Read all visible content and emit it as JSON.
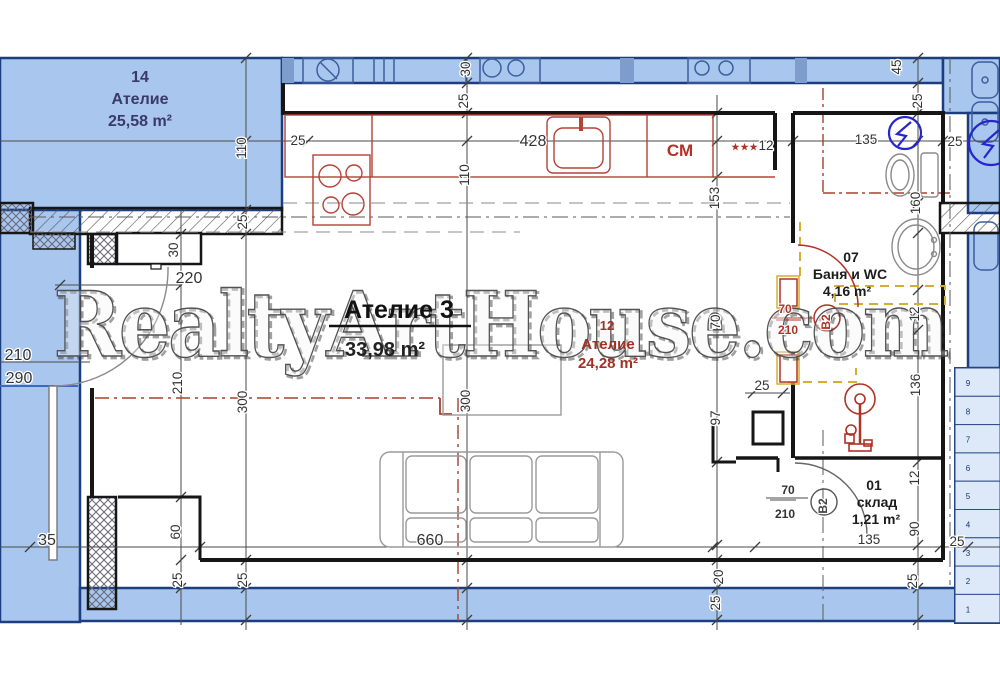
{
  "watermark": "RealtyArtHouse.com",
  "rooms": {
    "unit14": {
      "number": "14",
      "name": "Ателие",
      "area": "25,58 m²"
    },
    "main": {
      "title": "Ателие 3",
      "area": "33,98 m²"
    },
    "unit12": {
      "number": "12",
      "name": "Ателие",
      "area": "24,28 m²"
    },
    "bathroom": {
      "number": "07",
      "name": "Баня и WC",
      "area": "4,16 m²"
    },
    "storage": {
      "number": "01",
      "name": "склад",
      "area": "1,21 m²"
    }
  },
  "labels": {
    "washing_machine": "СМ",
    "stars": "★★★"
  },
  "doors": {
    "bathroom": {
      "width": "70",
      "height": "210",
      "code": "B2"
    },
    "storage": {
      "width": "70",
      "height": "210",
      "code": "B2"
    },
    "entrance": {
      "width": "210",
      "height": "290"
    }
  },
  "dimensions": [
    {
      "t": "110",
      "x": 246,
      "y": 148,
      "r": 1
    },
    {
      "t": "25",
      "x": 298,
      "y": 145,
      "r": 0
    },
    {
      "t": "30",
      "x": 470,
      "y": 69,
      "r": 1
    },
    {
      "t": "25",
      "x": 468,
      "y": 101,
      "r": 1
    },
    {
      "t": "428",
      "x": 533,
      "y": 146,
      "r": 0,
      "big": 1
    },
    {
      "t": "110",
      "x": 469,
      "y": 175,
      "r": 1
    },
    {
      "t": "12",
      "x": 766,
      "y": 150,
      "r": 0
    },
    {
      "t": "153",
      "x": 719,
      "y": 198,
      "r": 1
    },
    {
      "t": "135",
      "x": 866,
      "y": 144,
      "r": 0
    },
    {
      "t": "45",
      "x": 901,
      "y": 67,
      "r": 1
    },
    {
      "t": "25",
      "x": 922,
      "y": 101,
      "r": 1
    },
    {
      "t": "25",
      "x": 955,
      "y": 146,
      "r": 0
    },
    {
      "t": "160",
      "x": 920,
      "y": 203,
      "r": 1
    },
    {
      "t": "25",
      "x": 247,
      "y": 222,
      "r": 1
    },
    {
      "t": "30",
      "x": 178,
      "y": 250,
      "r": 1
    },
    {
      "t": "220",
      "x": 189,
      "y": 283,
      "r": 0,
      "big": 1
    },
    {
      "t": "210",
      "x": 182,
      "y": 383,
      "r": 1
    },
    {
      "t": "300",
      "x": 247,
      "y": 402,
      "r": 1
    },
    {
      "t": "300",
      "x": 470,
      "y": 401,
      "r": 1
    },
    {
      "t": "70",
      "x": 720,
      "y": 322,
      "r": 1
    },
    {
      "t": "97",
      "x": 720,
      "y": 418,
      "r": 1
    },
    {
      "t": "12",
      "x": 919,
      "y": 314,
      "r": 1
    },
    {
      "t": "136",
      "x": 920,
      "y": 385,
      "r": 1
    },
    {
      "t": "25",
      "x": 762,
      "y": 390,
      "r": 0
    },
    {
      "t": "60",
      "x": 180,
      "y": 532,
      "r": 1
    },
    {
      "t": "35",
      "x": 47,
      "y": 545,
      "r": 0,
      "big": 1
    },
    {
      "t": "660",
      "x": 430,
      "y": 545,
      "r": 0,
      "big": 1
    },
    {
      "t": "135",
      "x": 869,
      "y": 544,
      "r": 0
    },
    {
      "t": "25",
      "x": 957,
      "y": 546,
      "r": 0
    },
    {
      "t": "12",
      "x": 919,
      "y": 478,
      "r": 1
    },
    {
      "t": "90",
      "x": 919,
      "y": 529,
      "r": 1
    },
    {
      "t": "20",
      "x": 723,
      "y": 577,
      "r": 1
    },
    {
      "t": "25",
      "x": 720,
      "y": 603,
      "r": 1
    },
    {
      "t": "25",
      "x": 182,
      "y": 580,
      "r": 1
    },
    {
      "t": "25",
      "x": 247,
      "y": 580,
      "r": 1
    },
    {
      "t": "25",
      "x": 917,
      "y": 581,
      "r": 1
    },
    {
      "t": "210",
      "x": 18,
      "y": 360,
      "r": 0,
      "big": 1
    },
    {
      "t": "290",
      "x": 19,
      "y": 383,
      "r": 0,
      "big": 1
    }
  ],
  "stairs": [
    "9",
    "8",
    "7",
    "6",
    "5",
    "4",
    "3",
    "2",
    "1"
  ],
  "colors": {
    "unit_fill": "#a9c7ee",
    "unit_border": "#1c3e7e",
    "wall": "#161616",
    "red": "#b03226",
    "dim_text": "#333333",
    "yellow": "#d4ae35",
    "electric": "#2626cc",
    "navy_text": "#3a3a68"
  }
}
